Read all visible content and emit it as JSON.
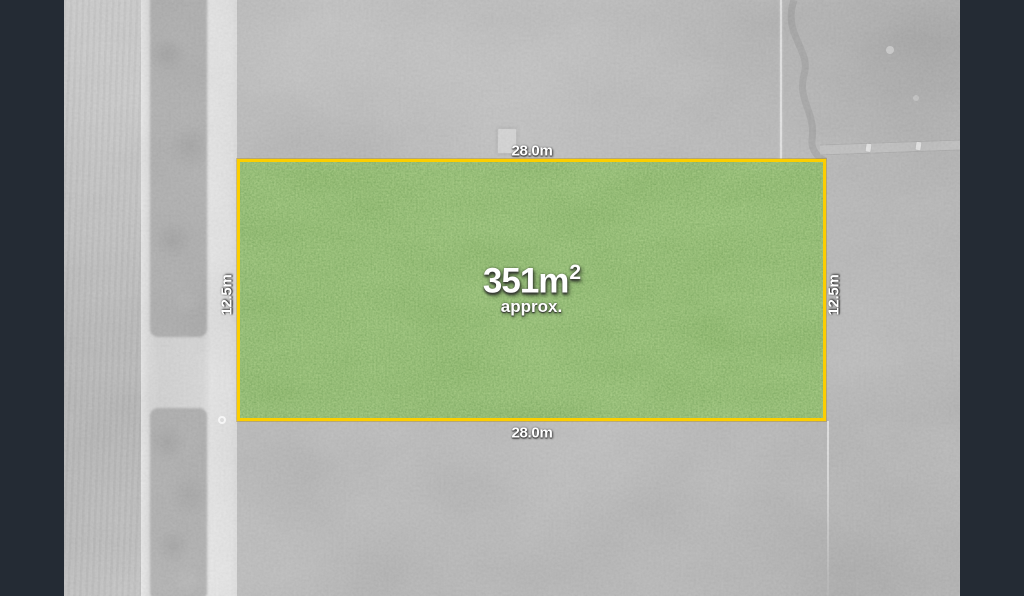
{
  "colors": {
    "letterbox": "#242b34",
    "parcel_border": "#fcce00",
    "parcel_fill": "#579343",
    "label_text": "#ffffff"
  },
  "parcel": {
    "area": "351m",
    "area_superscript": "2",
    "area_qualifier": "approx.",
    "dimensions": {
      "top": "28.0m",
      "bottom": "28.0m",
      "left": "12.5m",
      "right": "12.5m"
    }
  }
}
